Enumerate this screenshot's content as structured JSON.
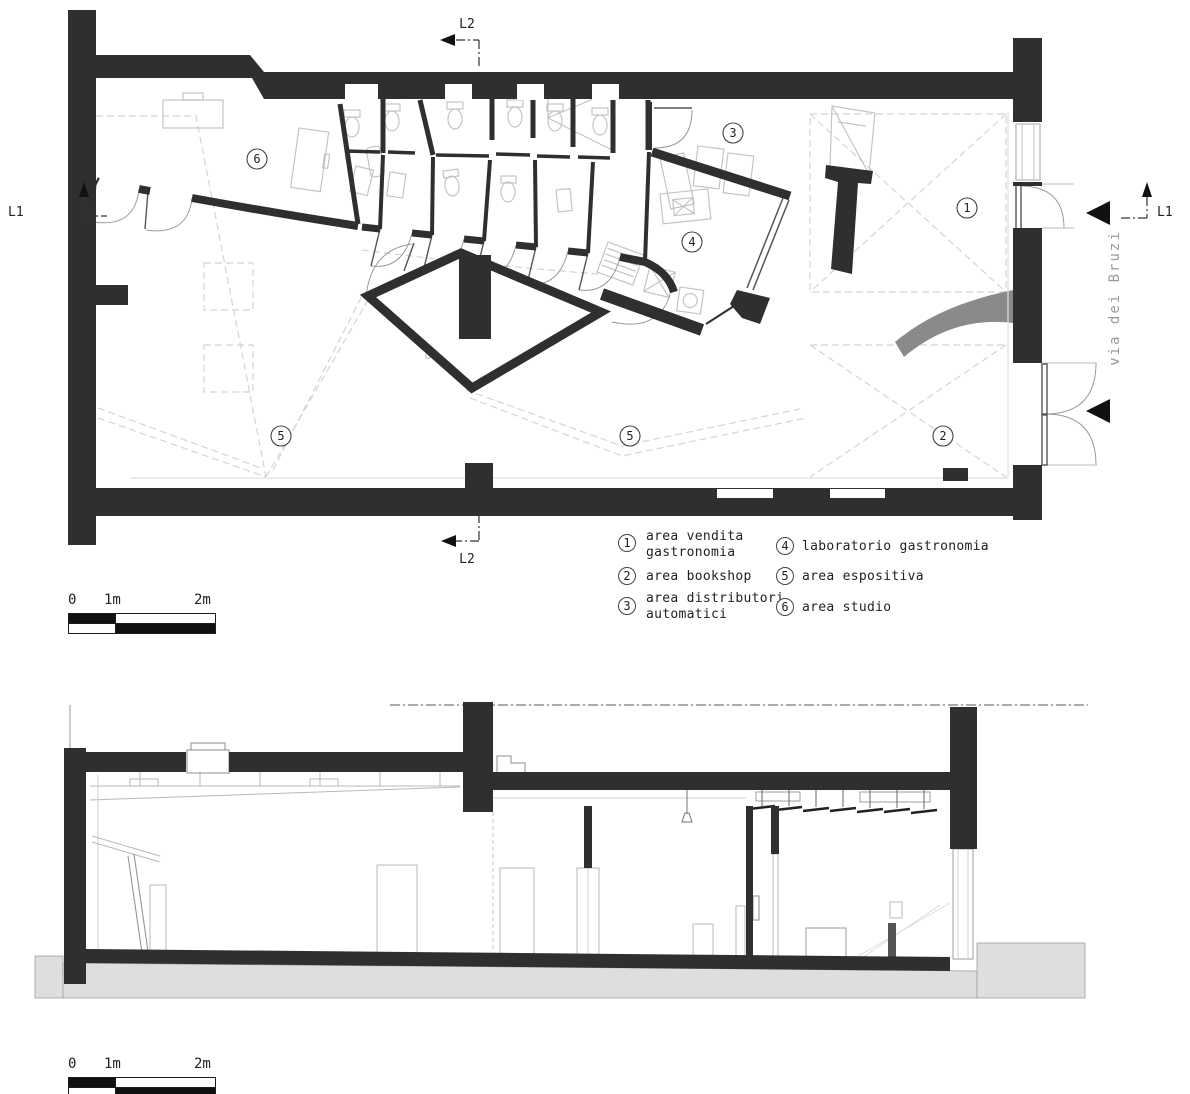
{
  "plan": {
    "street_name": "via dei Bruzi",
    "markers": {
      "l1": "L1",
      "l2": "L2"
    },
    "areas": [
      {
        "num": "6"
      },
      {
        "num": "3"
      },
      {
        "num": "4"
      },
      {
        "num": "1"
      },
      {
        "num": "5"
      },
      {
        "num": "5"
      },
      {
        "num": "2"
      }
    ]
  },
  "legend": {
    "items": [
      {
        "num": "1",
        "line1": "area vendita",
        "line2": "gastronomia"
      },
      {
        "num": "2",
        "line1": "area bookshop",
        "line2": ""
      },
      {
        "num": "3",
        "line1": "area distributori",
        "line2": "automatici"
      },
      {
        "num": "4",
        "line1": "laboratorio gastronomia",
        "line2": ""
      },
      {
        "num": "5",
        "line1": "area espositiva",
        "line2": ""
      },
      {
        "num": "6",
        "line1": "area studio",
        "line2": ""
      }
    ]
  },
  "scalebars": {
    "top": {
      "labels": [
        "0",
        "1m",
        "2m"
      ]
    },
    "bottom": {
      "labels": [
        "0",
        "1m",
        "2m"
      ]
    }
  },
  "colors": {
    "wall": "#2f2f2f",
    "ramp": "#8a8a8a",
    "ground": "#dedede",
    "furniture_line": "#c4c4c4",
    "street_text": "#9a9a9a"
  }
}
